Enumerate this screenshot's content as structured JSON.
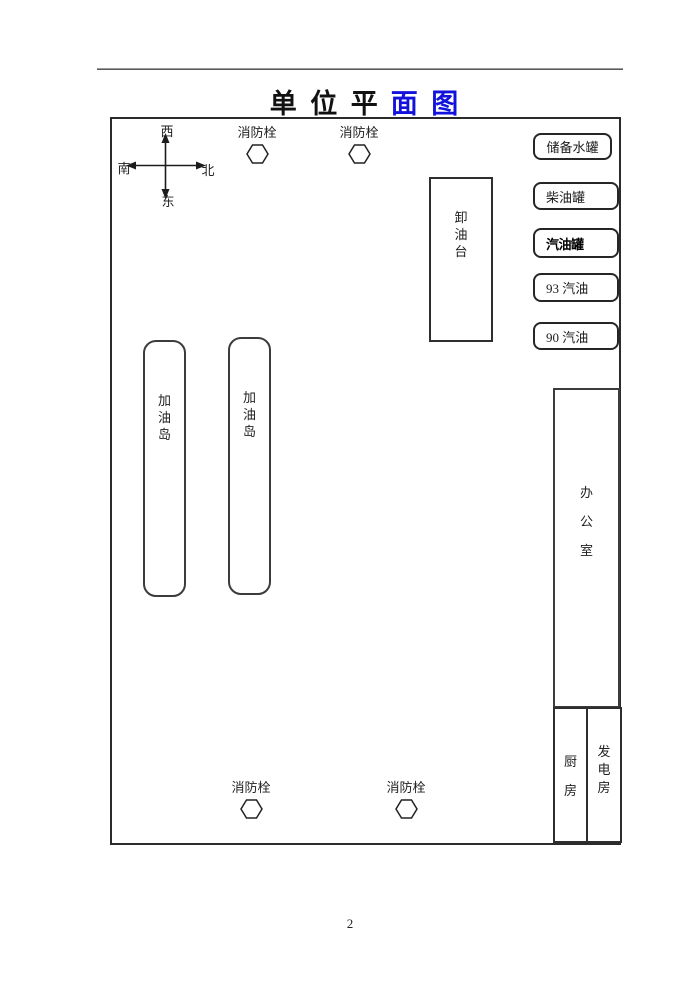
{
  "document": {
    "title": {
      "black_part": "单 位 平",
      "blue_part": "面 图",
      "blue_color": "#1212dd"
    },
    "page_number": "2"
  },
  "compass": {
    "top": "西",
    "left": "南",
    "right": "北",
    "bottom": "东"
  },
  "fire_hydrant": {
    "label": "消防栓"
  },
  "plan": {
    "unloading_platform": "卸油台",
    "fuel_island": "加油岛",
    "office": "办公室",
    "kitchen": "厨房",
    "generator_room": "发电房",
    "tanks": [
      {
        "label": "储备水罐"
      },
      {
        "label": "柴油罐"
      },
      {
        "label": "汽油罐"
      },
      {
        "label": "93 汽油"
      },
      {
        "label": "90 汽油"
      }
    ]
  }
}
